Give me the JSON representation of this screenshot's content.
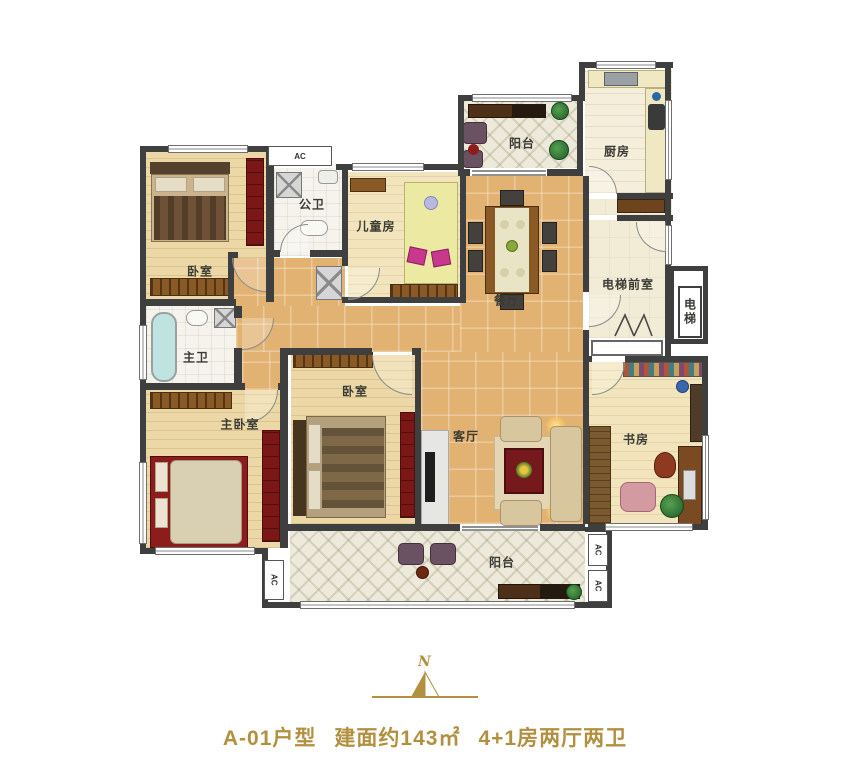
{
  "rooms": {
    "bedroom_top_left": {
      "label": "卧室"
    },
    "public_bath": {
      "label": "公卫"
    },
    "children_room": {
      "label": "儿童房"
    },
    "balcony_top": {
      "label": "阳台"
    },
    "kitchen": {
      "label": "厨房"
    },
    "dining": {
      "label": "餐厅"
    },
    "elevator_lobby": {
      "label": "电梯前室"
    },
    "elevator": {
      "label": "电梯"
    },
    "master_bath": {
      "label": "主卫"
    },
    "master_bedroom": {
      "label": "主卧室"
    },
    "bedroom_mid": {
      "label": "卧室"
    },
    "living": {
      "label": "客厅"
    },
    "study": {
      "label": "书房"
    },
    "balcony_bottom": {
      "label": "阳台"
    }
  },
  "ac_label": "AC",
  "north": {
    "letter": "N"
  },
  "caption": {
    "unit_name": "A-01户型",
    "area": "建面约143㎡",
    "layout": "4+1房两厅两卫"
  },
  "colors": {
    "accent_gold": "#b2903f",
    "wall": "#3f3f3f",
    "tile_tan": "#e2b273",
    "wood": "#ecd8a6",
    "lattice": "#eeeadb",
    "red_furniture": "#7c1717"
  }
}
